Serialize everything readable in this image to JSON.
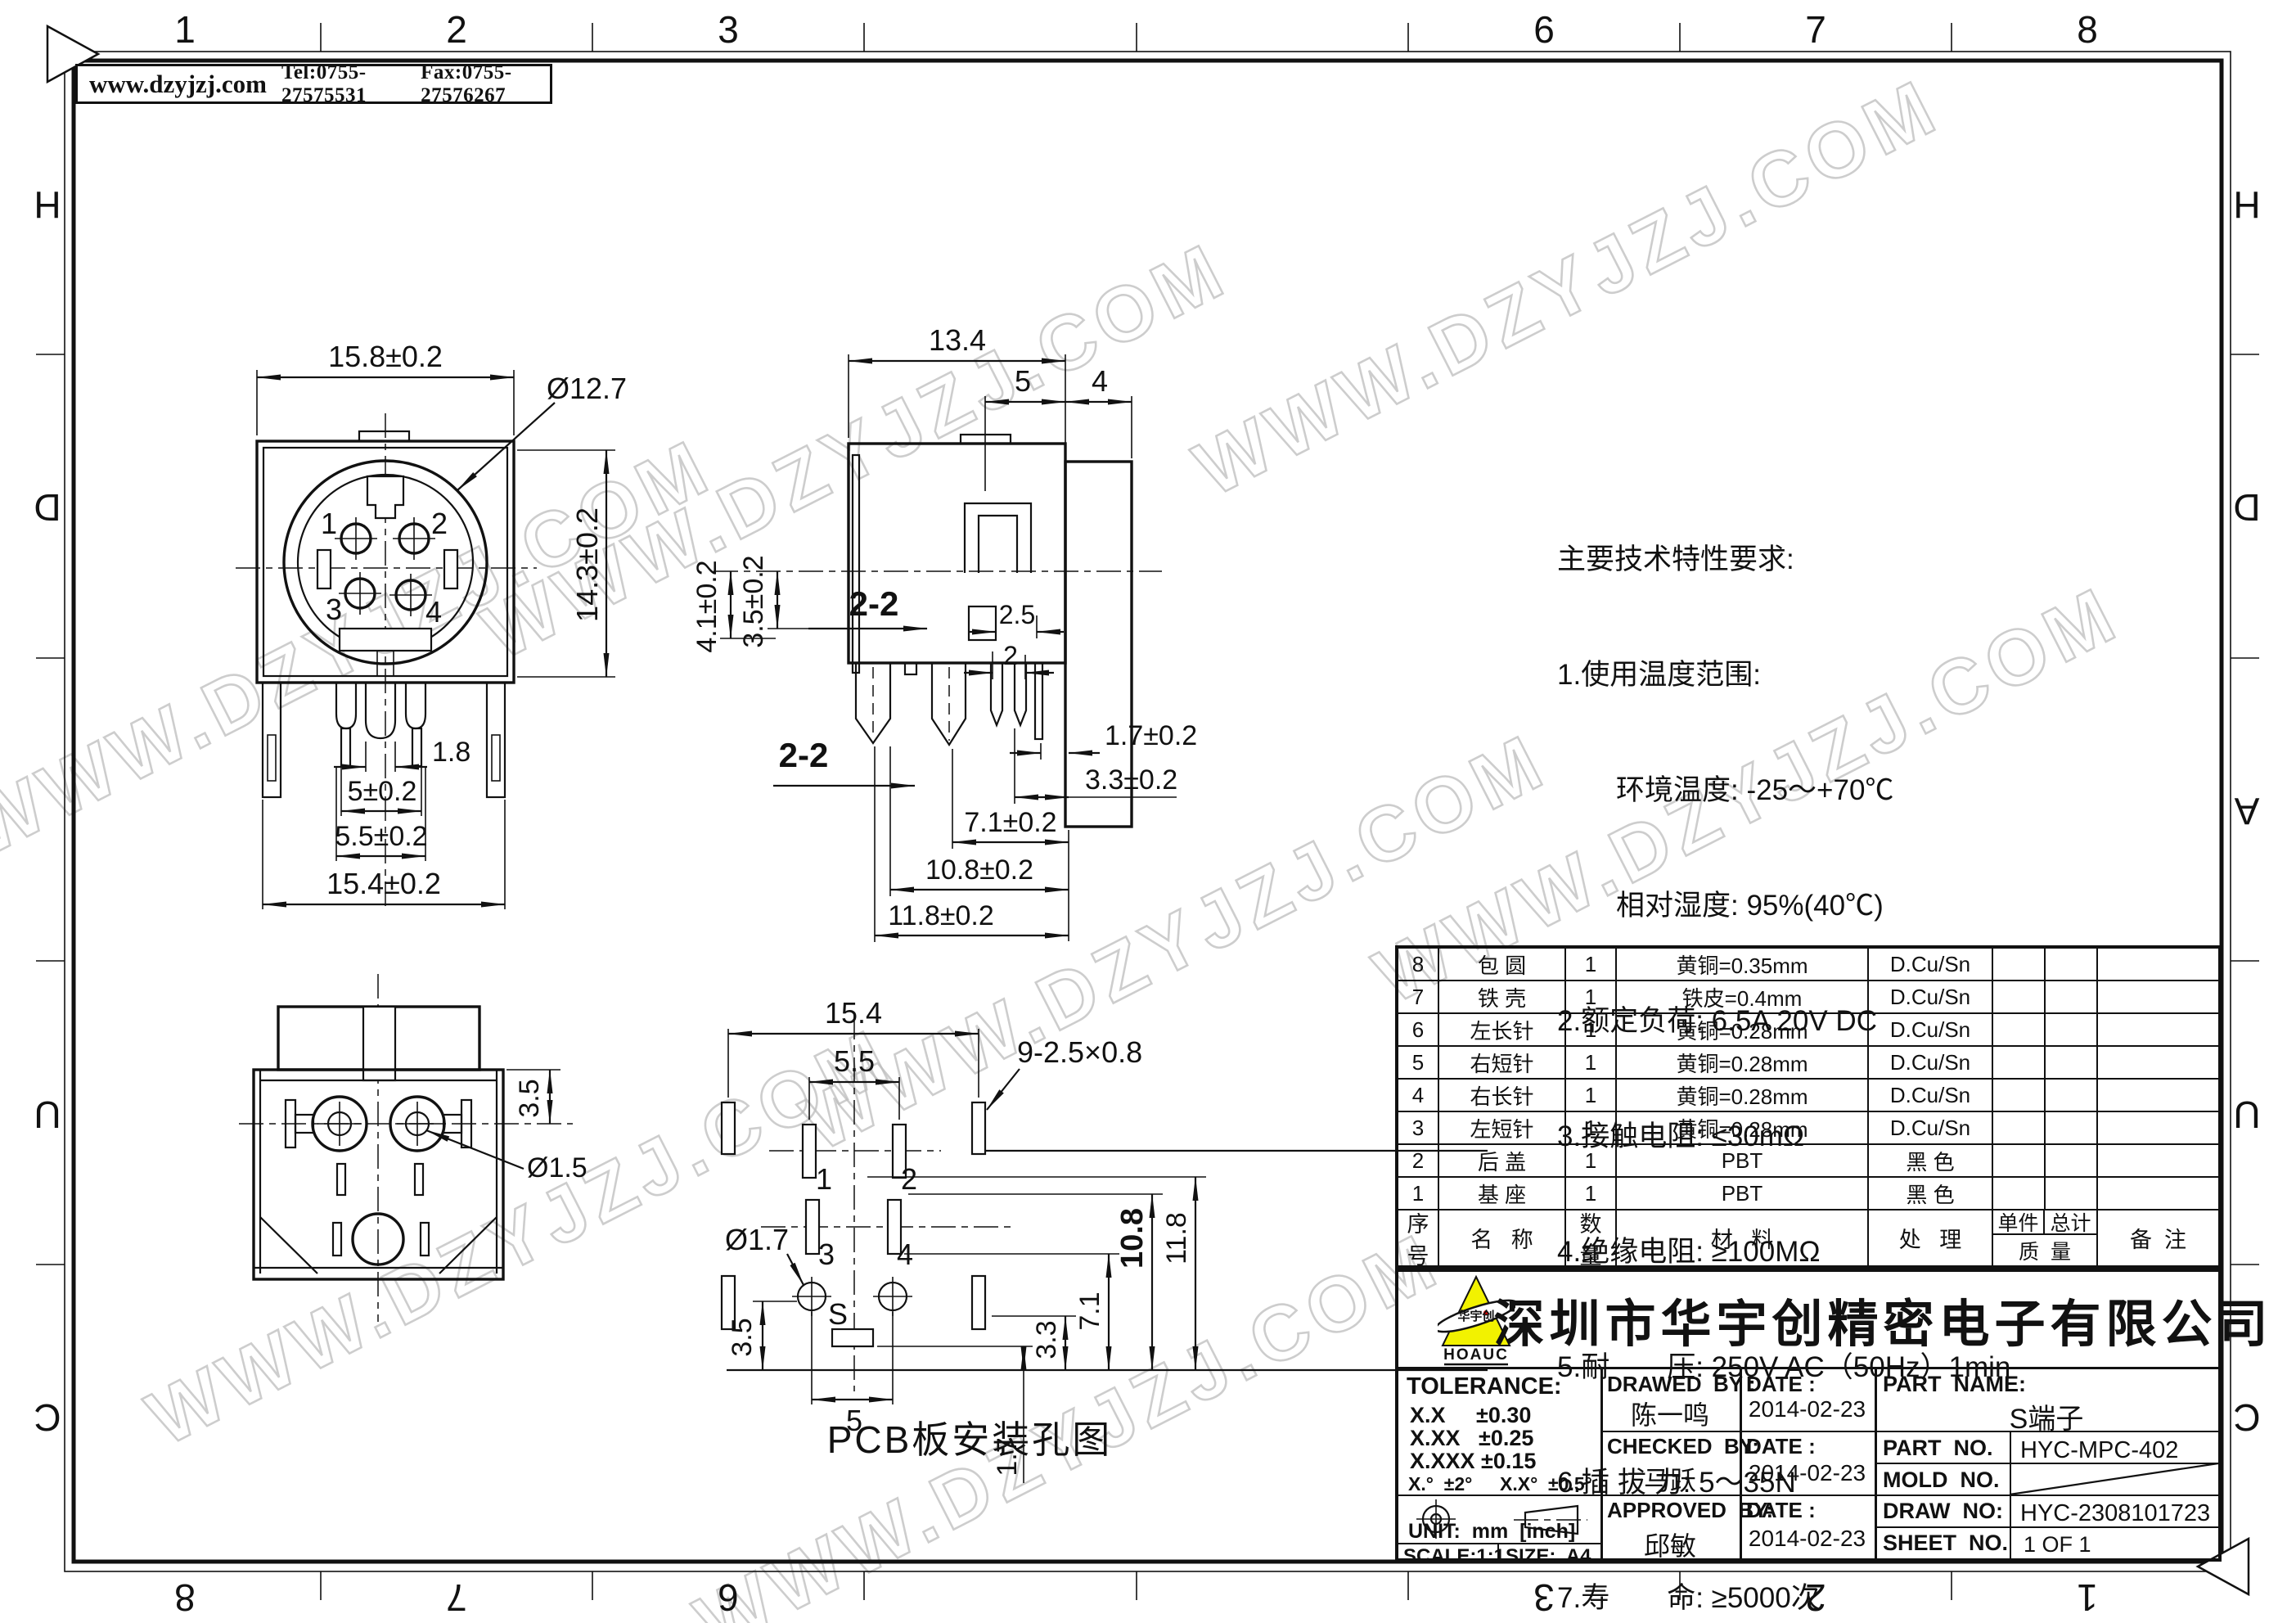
{
  "banner": {
    "site": "www.dzyjzj.com",
    "tel": "Tel:0755-27575531",
    "fax": "Fax:0755-27576267"
  },
  "watermark_text": "WWW.DZYJZJ.COM",
  "frame": {
    "top_numbers": [
      "1",
      "2",
      "3",
      "6",
      "7",
      "8"
    ],
    "bottom_numbers": [
      "8",
      "7",
      "6",
      "3",
      "2",
      "1"
    ],
    "left_letters": [
      "H",
      "D",
      "U",
      "C"
    ],
    "right_letters": [
      "H",
      "D",
      "A",
      "U",
      "C"
    ]
  },
  "front_view": {
    "dim_width": "15.8±0.2",
    "dim_diameter": "Ø12.7",
    "dim_height": "14.3±0.2",
    "dim_pin": "1.8",
    "dim_span_inner": "5±0.2",
    "dim_span_mid": "5.5±0.2",
    "dim_span_outer": "15.4±0.2",
    "pins": [
      "1",
      "2",
      "3",
      "4"
    ]
  },
  "side_view": {
    "dim_width": "13.4",
    "dim_top_a": "5",
    "dim_top_b": "4",
    "dim_left_a": "4.1±0.2",
    "dim_left_b": "3.5±0.2",
    "dim_step_a": "2.5",
    "dim_step_b": "2",
    "section_label": "2-2",
    "dim_b1": "1.7±0.2",
    "dim_b2": "3.3±0.2",
    "dim_b3": "7.1±0.2",
    "dim_b4": "10.8±0.2",
    "dim_b5": "11.8±0.2"
  },
  "bottom_view": {
    "dim_offset": "3.5",
    "dim_hole": "Ø1.5"
  },
  "pcb_view": {
    "caption": "PCB板安装孔图",
    "dim_width": "15.4",
    "dim_mid": "5.5",
    "dim_slots": "9-2.5×0.8",
    "dim_hole": "Ø1.7",
    "dim_left": "3.5",
    "dim_bottom": "5",
    "dim_s": "1.7",
    "dim_r1": "3.3",
    "dim_r2": "7.1",
    "dim_r3": "10.8",
    "dim_r4": "11.8",
    "pads": [
      "1",
      "2",
      "3",
      "4",
      "S"
    ]
  },
  "tech": {
    "l0": "主要技术特性要求:",
    "l1": "1.使用温度范围:",
    "l2": "环境温度: -25～+70℃",
    "l3": "相对湿度: 95%(40℃)",
    "l4": "2.额定负荷: 6.5A 20V DC",
    "l5": "3.接触电阻: ≤30mΩ",
    "l6": "4.绝缘电阻: ≥100MΩ",
    "l7": "5.耐　　压: 250V AC（50Hz）1min",
    "l8": "6.插 拔 力: 5～35N",
    "l9": "7.寿　　命: ≥5000次"
  },
  "bom": {
    "headers": {
      "no": "序\n号",
      "name": "名   称",
      "qty": "数\n量",
      "material": "材   料",
      "process": "处   理",
      "unit": "单件",
      "total": "总计",
      "mass": "质  量",
      "remark": "备  注"
    },
    "rows": [
      {
        "no": "8",
        "name": "包 圆",
        "qty": "1",
        "material": "黄铜=0.35mm",
        "process": "D.Cu/Sn"
      },
      {
        "no": "7",
        "name": "铁 壳",
        "qty": "1",
        "material": "铁皮=0.4mm",
        "process": "D.Cu/Sn"
      },
      {
        "no": "6",
        "name": "左长针",
        "qty": "1",
        "material": "黄铜=0.28mm",
        "process": "D.Cu/Sn"
      },
      {
        "no": "5",
        "name": "右短针",
        "qty": "1",
        "material": "黄铜=0.28mm",
        "process": "D.Cu/Sn"
      },
      {
        "no": "4",
        "name": "右长针",
        "qty": "1",
        "material": "黄铜=0.28mm",
        "process": "D.Cu/Sn"
      },
      {
        "no": "3",
        "name": "左短针",
        "qty": "1",
        "material": "黄铜=0.28mm",
        "process": "D.Cu/Sn"
      },
      {
        "no": "2",
        "name": "后 盖",
        "qty": "1",
        "material": "PBT",
        "process": "黑 色"
      },
      {
        "no": "1",
        "name": "基 座",
        "qty": "1",
        "material": "PBT",
        "process": "黑 色"
      }
    ]
  },
  "title_block": {
    "company": "深圳市华宇创精密电子有限公司",
    "logo_text": "HOAUC",
    "logo_cn": "华宇创",
    "tolerance_title": "TOLERANCE:",
    "tol1": "X.X     ±0.30",
    "tol2": "X.XX   ±0.25",
    "tol3": "X.XXX ±0.15",
    "tol4a": "X.°  ±2°",
    "tol4b": "X.X°  ±0.5°",
    "unit": "UNIT:  mm  [inch]",
    "scale": "SCALE:1:1",
    "size": "SIZE:  A4",
    "drawed_label": "DRAWED  BY :",
    "drawed_by": "陈一鸣",
    "checked_label": "CHECKED  BY:",
    "checked_by": "马跃",
    "approved_label": "APPROVED  BY:",
    "approved_by": "邱敏",
    "date_label": "DATE :",
    "date1": "2014-02-23",
    "date2": "2014-02-23",
    "date3": "2014-02-23",
    "part_name_label": "PART  NAME:",
    "part_name": "S端子",
    "part_no_label": "PART  NO.",
    "part_no": "HYC-MPC-402",
    "mold_no_label": "MOLD  NO.",
    "draw_no_label": "DRAW  NO:",
    "draw_no": "HYC-2308101723",
    "sheet_no_label": "SHEET  NO.",
    "sheet_no": "1 OF 1"
  }
}
